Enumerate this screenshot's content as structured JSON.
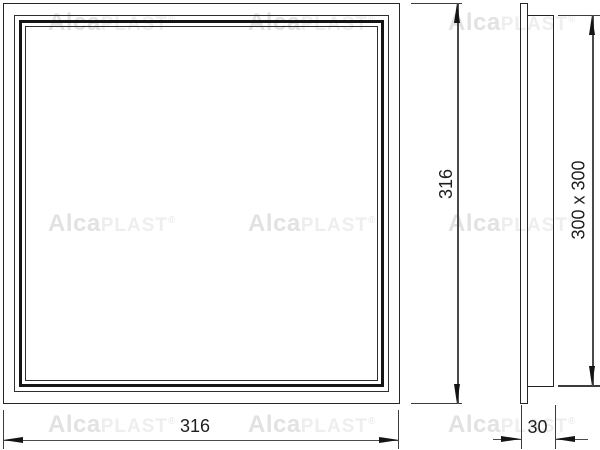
{
  "watermark": {
    "bold": "Alca",
    "light": "PLAST",
    "registered": "®"
  },
  "dimensions": {
    "front_width": "316",
    "front_height": "316",
    "opening_size": "300 x 300",
    "depth": "30"
  },
  "colors": {
    "line": "#262626",
    "thick_frame": "#141414",
    "dimension_line": "#4a4a4a",
    "watermark_gray": "#e2e2e2",
    "background": "#ffffff"
  }
}
